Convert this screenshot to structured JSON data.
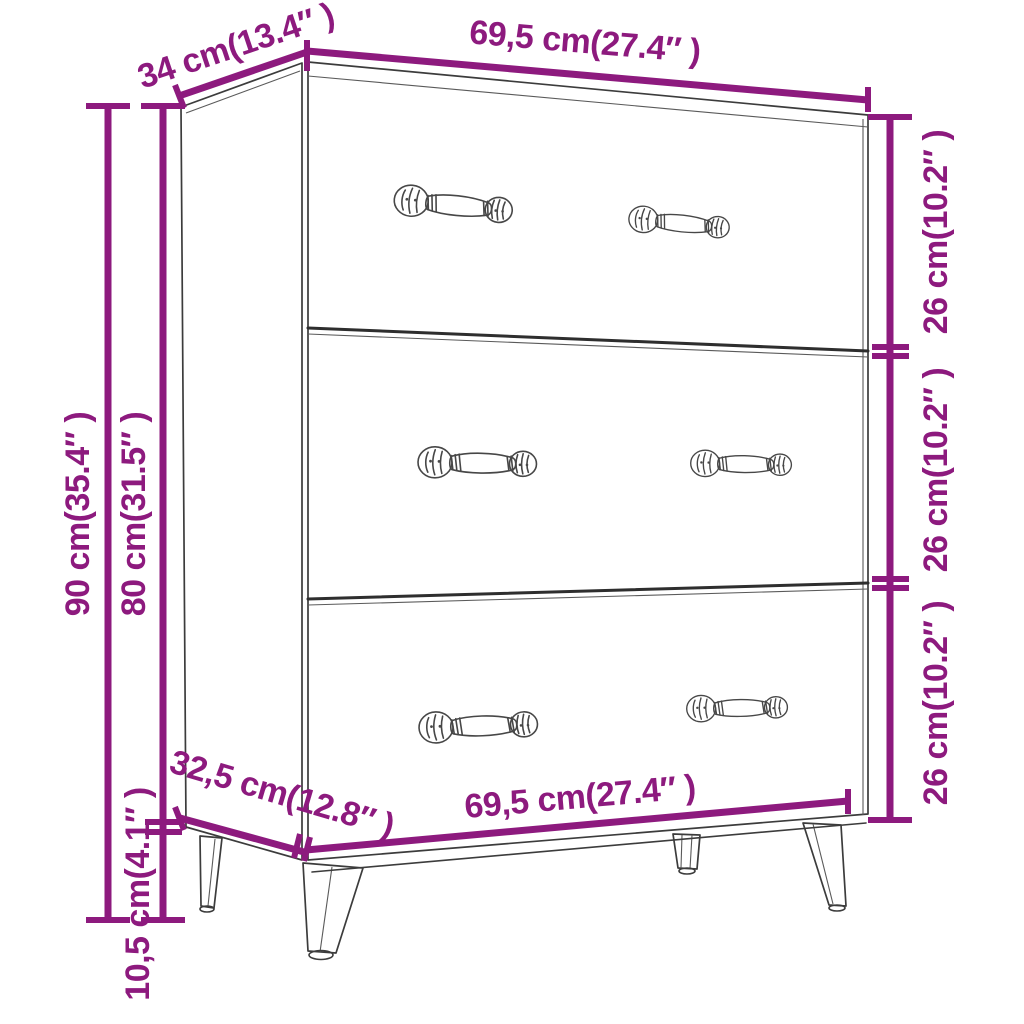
{
  "diagram": {
    "subject": "Sideboard with three drawers — product dimension drawing",
    "colors": {
      "dimension_color": "#8d1a7e",
      "line_art_color": "#3c3c3c",
      "background": "#ffffff"
    },
    "labels": {
      "top_depth": "34 cm(13.4″ )",
      "top_width": "69,5 cm(27.4″ )",
      "right_drawer_heights": [
        "26 cm(10.2″ )",
        "26 cm(10.2″ )",
        "26 cm(10.2″ )"
      ],
      "left_total_height": "90 cm(35.4″ )",
      "left_body_height": "80 cm(31.5″ )",
      "left_leg_height": "10,5 cm(4.1″ )",
      "bottom_depth": "32,5 cm(12.8″ )",
      "bottom_width": "69,5 cm(27.4″ )"
    }
  }
}
